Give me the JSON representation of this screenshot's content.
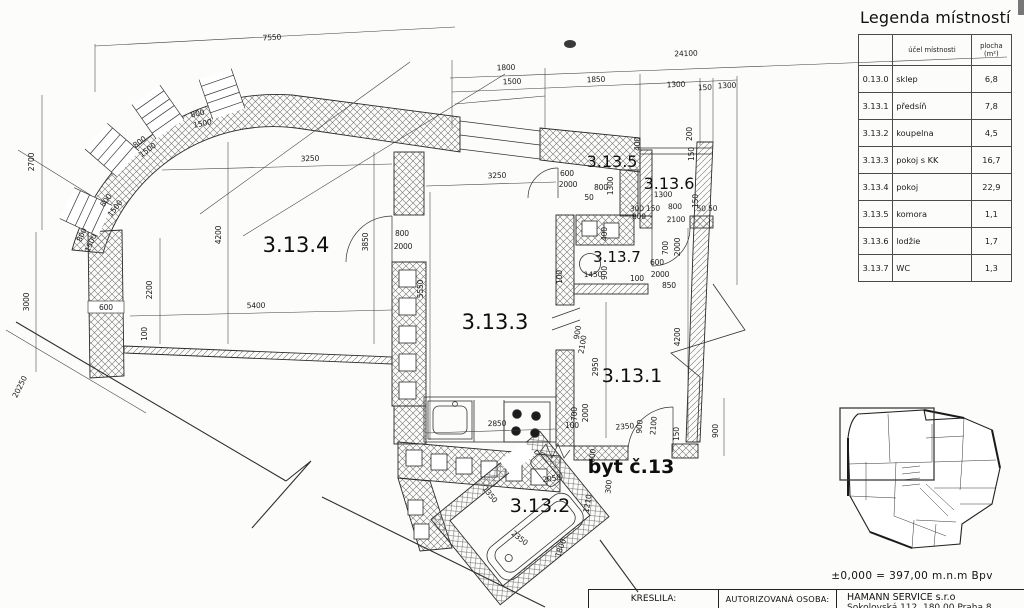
{
  "legend": {
    "title": "Legenda místností",
    "columns": [
      "",
      "účel místnosti",
      "plocha (m²)"
    ],
    "rows": [
      {
        "id": "0.13.0",
        "name": "sklep",
        "area": "6,8"
      },
      {
        "id": "3.13.1",
        "name": "předsíň",
        "area": "7,8"
      },
      {
        "id": "3.13.2",
        "name": "koupelna",
        "area": "4,5"
      },
      {
        "id": "3.13.3",
        "name": "pokoj s KK",
        "area": "16,7"
      },
      {
        "id": "3.13.4",
        "name": "pokoj",
        "area": "22,9"
      },
      {
        "id": "3.13.5",
        "name": "komora",
        "area": "1,1"
      },
      {
        "id": "3.13.6",
        "name": "lodžie",
        "area": "1,7"
      },
      {
        "id": "3.13.7",
        "name": "WC",
        "area": "1,3"
      }
    ]
  },
  "titleblock": {
    "elevation": "±0,000  =  397,00  m.n.m  Bpv",
    "drawn_by_label": "KRESLILA:",
    "authorized_label": "AUTORIZOVANÁ OSOBA:",
    "company": "HAMANN SERVICE s.r.o",
    "company_address": "Sokolovská 112, 180 00 Praha 8"
  },
  "plan": {
    "apartment_label": "byt č.13",
    "room_labels": [
      {
        "label": "3.13.4",
        "x": 296,
        "y": 252,
        "fs": 21
      },
      {
        "label": "3.13.3",
        "x": 495,
        "y": 329,
        "fs": 21
      },
      {
        "label": "3.13.1",
        "x": 632,
        "y": 382,
        "fs": 19
      },
      {
        "label": "3.13.2",
        "x": 540,
        "y": 512,
        "fs": 19
      },
      {
        "label": "3.13.5",
        "x": 612,
        "y": 167,
        "fs": 16
      },
      {
        "label": "3.13.6",
        "x": 669,
        "y": 189,
        "fs": 16
      },
      {
        "label": "3.13.7",
        "x": 617,
        "y": 262,
        "fs": 15
      },
      {
        "label": "byt č.13",
        "x": 631,
        "y": 473,
        "fs": 19,
        "bold": true
      }
    ],
    "dimension_labels": [
      {
        "t": "7550",
        "x": 272,
        "y": 40,
        "r": -3
      },
      {
        "t": "24100",
        "x": 686,
        "y": 56,
        "r": -2
      },
      {
        "t": "1800",
        "x": 506,
        "y": 70,
        "r": -2
      },
      {
        "t": "1500",
        "x": 512,
        "y": 84,
        "r": -2
      },
      {
        "t": "1850",
        "x": 596,
        "y": 82,
        "r": -2
      },
      {
        "t": "1300",
        "x": 676,
        "y": 87,
        "r": -2
      },
      {
        "t": "150",
        "x": 705,
        "y": 90,
        "r": -2
      },
      {
        "t": "1300",
        "x": 727,
        "y": 88,
        "r": -2
      },
      {
        "t": "2700",
        "x": 34,
        "y": 162,
        "r": -90
      },
      {
        "t": "3000",
        "x": 29,
        "y": 302,
        "r": -90
      },
      {
        "t": "20250",
        "x": 22,
        "y": 388,
        "r": -63
      },
      {
        "t": "800",
        "x": 84,
        "y": 236,
        "r": -66
      },
      {
        "t": "1500",
        "x": 93,
        "y": 244,
        "r": -66
      },
      {
        "t": "800",
        "x": 108,
        "y": 202,
        "r": -52
      },
      {
        "t": "1500",
        "x": 117,
        "y": 210,
        "r": -52
      },
      {
        "t": "800",
        "x": 141,
        "y": 144,
        "r": -36
      },
      {
        "t": "1500",
        "x": 149,
        "y": 152,
        "r": -36
      },
      {
        "t": "800",
        "x": 198,
        "y": 116,
        "r": -12
      },
      {
        "t": "1500",
        "x": 203,
        "y": 126,
        "r": -12
      },
      {
        "t": "600",
        "x": 106,
        "y": 310,
        "r": 0
      },
      {
        "t": "2200",
        "x": 152,
        "y": 290,
        "r": -90
      },
      {
        "t": "100",
        "x": 147,
        "y": 334,
        "r": -90
      },
      {
        "t": "4200",
        "x": 221,
        "y": 235,
        "r": -90
      },
      {
        "t": "5400",
        "x": 256,
        "y": 308,
        "r": -1
      },
      {
        "t": "3250",
        "x": 310,
        "y": 161,
        "r": -2
      },
      {
        "t": "3850",
        "x": 368,
        "y": 242,
        "r": -90
      },
      {
        "t": "800",
        "x": 402,
        "y": 236,
        "r": 0
      },
      {
        "t": "2000",
        "x": 403,
        "y": 249,
        "r": 0
      },
      {
        "t": "5550",
        "x": 423,
        "y": 289,
        "r": -90
      },
      {
        "t": "3250",
        "x": 497,
        "y": 178,
        "r": -2
      },
      {
        "t": "2850",
        "x": 497,
        "y": 426,
        "r": -1
      },
      {
        "t": "600",
        "x": 567,
        "y": 176,
        "r": 0
      },
      {
        "t": "2000",
        "x": 568,
        "y": 187,
        "r": 0
      },
      {
        "t": "50",
        "x": 589,
        "y": 200,
        "r": 0
      },
      {
        "t": "800",
        "x": 601,
        "y": 190,
        "r": 0
      },
      {
        "t": "1300",
        "x": 613,
        "y": 186,
        "r": -90
      },
      {
        "t": "400",
        "x": 640,
        "y": 144,
        "r": -90
      },
      {
        "t": "200",
        "x": 692,
        "y": 134,
        "r": -90
      },
      {
        "t": "150",
        "x": 694,
        "y": 154,
        "r": -90
      },
      {
        "t": "1300",
        "x": 663,
        "y": 197,
        "r": -1
      },
      {
        "t": "150",
        "x": 698,
        "y": 201,
        "r": -90
      },
      {
        "t": "300 150",
        "x": 645,
        "y": 211,
        "r": -1
      },
      {
        "t": "800",
        "x": 675,
        "y": 209,
        "r": -1
      },
      {
        "t": "50 50",
        "x": 707,
        "y": 211,
        "r": -1
      },
      {
        "t": "800",
        "x": 639,
        "y": 219,
        "r": -1
      },
      {
        "t": "2100",
        "x": 676,
        "y": 222,
        "r": -1
      },
      {
        "t": "400",
        "x": 607,
        "y": 234,
        "r": -90
      },
      {
        "t": "700",
        "x": 668,
        "y": 248,
        "r": -90
      },
      {
        "t": "2000",
        "x": 680,
        "y": 247,
        "r": -90
      },
      {
        "t": "600",
        "x": 657,
        "y": 265,
        "r": 0
      },
      {
        "t": "2000",
        "x": 660,
        "y": 277,
        "r": 0
      },
      {
        "t": "850",
        "x": 669,
        "y": 288,
        "r": 0
      },
      {
        "t": "100",
        "x": 562,
        "y": 277,
        "r": -90
      },
      {
        "t": "1450",
        "x": 593,
        "y": 277,
        "r": -1
      },
      {
        "t": "900",
        "x": 607,
        "y": 273,
        "r": -90
      },
      {
        "t": "100",
        "x": 637,
        "y": 281,
        "r": 0
      },
      {
        "t": "900",
        "x": 580,
        "y": 333,
        "r": -80
      },
      {
        "t": "2100",
        "x": 585,
        "y": 345,
        "r": -80
      },
      {
        "t": "2950",
        "x": 598,
        "y": 367,
        "r": -90
      },
      {
        "t": "4200",
        "x": 680,
        "y": 337,
        "r": -90
      },
      {
        "t": "900",
        "x": 718,
        "y": 431,
        "r": -90
      },
      {
        "t": "700",
        "x": 577,
        "y": 414,
        "r": -90
      },
      {
        "t": "2000",
        "x": 588,
        "y": 413,
        "r": -90
      },
      {
        "t": "100",
        "x": 572,
        "y": 428,
        "r": 0
      },
      {
        "t": "2350",
        "x": 625,
        "y": 429,
        "r": -5
      },
      {
        "t": "900",
        "x": 642,
        "y": 427,
        "r": -85
      },
      {
        "t": "2100",
        "x": 656,
        "y": 426,
        "r": -85
      },
      {
        "t": "150",
        "x": 679,
        "y": 434,
        "r": -90
      },
      {
        "t": "600",
        "x": 595,
        "y": 456,
        "r": -85
      },
      {
        "t": "300",
        "x": 611,
        "y": 487,
        "r": -85
      },
      {
        "t": "1210",
        "x": 590,
        "y": 504,
        "r": -80
      },
      {
        "t": "2050",
        "x": 552,
        "y": 481,
        "r": -8
      },
      {
        "t": "1350",
        "x": 488,
        "y": 496,
        "r": 52
      },
      {
        "t": "2350",
        "x": 518,
        "y": 540,
        "r": 38
      },
      {
        "t": "1800",
        "x": 563,
        "y": 549,
        "r": -70
      }
    ]
  }
}
